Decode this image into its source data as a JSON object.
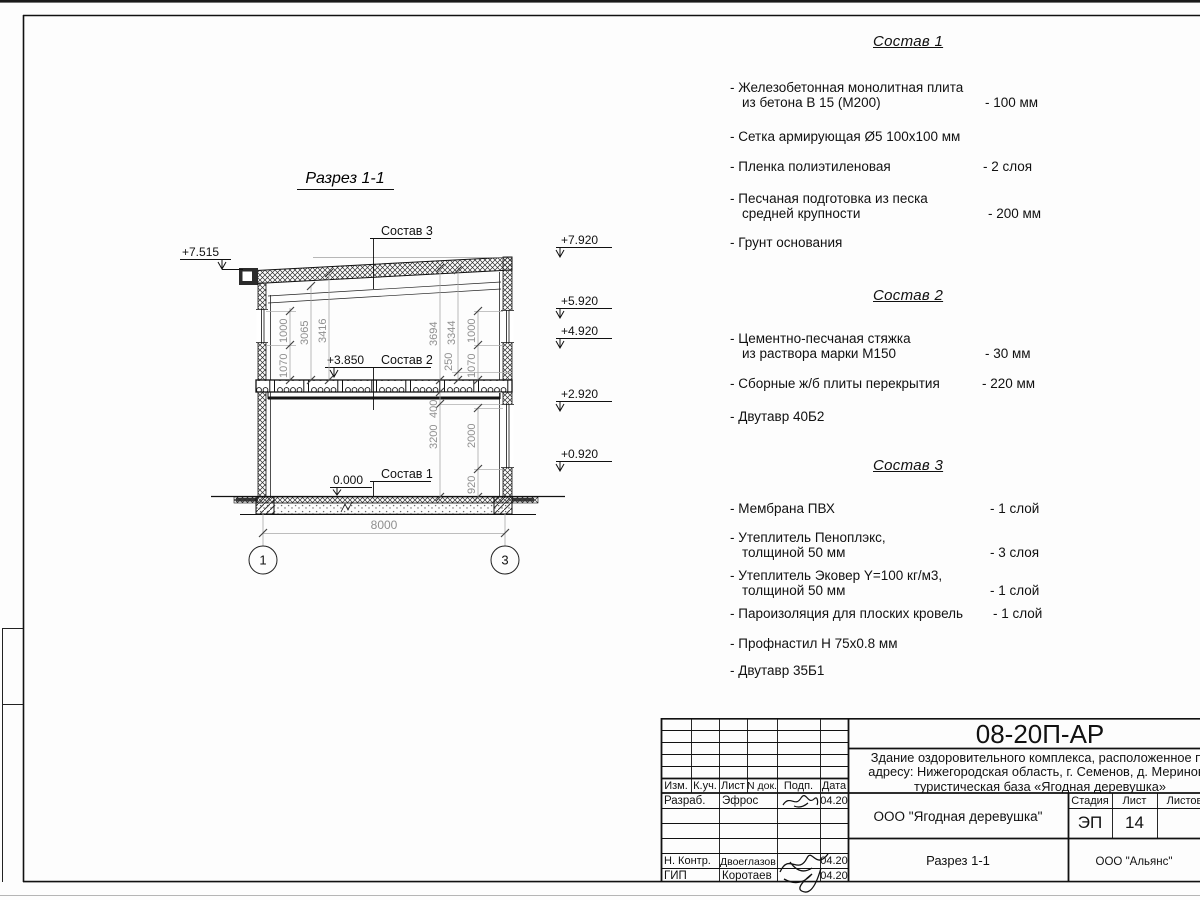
{
  "drawing": {
    "title": "Разрез 1-1",
    "elev_left_eave": "+7.515",
    "elev_right": [
      "+7.920",
      "+5.920",
      "+4.920",
      "+2.920",
      "+0.920"
    ],
    "elev_floor2": "+3.850",
    "elev_zero": "0.000",
    "label_sostav3": "Состав 3",
    "label_sostav2": "Состав 2",
    "label_sostav1": "Состав 1",
    "dims_left": [
      "1070",
      "1000",
      "3065",
      "3416"
    ],
    "dims_right_up": [
      "3694",
      "3344",
      "250",
      "1070",
      "1000"
    ],
    "dims_right_low": [
      "400",
      "3200",
      "2000",
      "920"
    ],
    "dim_span": "8000",
    "axis_left": "1",
    "axis_right": "3"
  },
  "specs": [
    {
      "title": "Состав 1",
      "items": [
        {
          "name": "- Железобетонная  монолитная плита\nиз бетона В 15 (М200)",
          "value": "- 100 мм"
        },
        {
          "name": "- Сетка армирующая Ø5 100х100 мм",
          "value": ""
        },
        {
          "name": "- Пленка полиэтиленовая",
          "value": "-  2 слоя"
        },
        {
          "name": "- Песчаная подготовка из песка\nсредней крупности",
          "value": "- 200 мм"
        },
        {
          "name": "- Грунт основания",
          "value": ""
        }
      ]
    },
    {
      "title": "Состав 2",
      "items": [
        {
          "name": "- Цементно-песчаная стяжка\nиз раствора марки М150",
          "value": "- 30 мм"
        },
        {
          "name": "- Сборные ж/б плиты перекрытия",
          "value": "- 220 мм"
        },
        {
          "name": "- Двутавр 40Б2",
          "value": ""
        }
      ]
    },
    {
      "title": "Состав 3",
      "items": [
        {
          "name": "- Мембрана ПВХ",
          "value": "- 1 слой"
        },
        {
          "name": "- Утеплитель Пеноплэкс,\nтолщиной 50 мм",
          "value": "- 3 слоя"
        },
        {
          "name": "- Утеплитель Эковер Y=100 кг/м3,\nтолщиной 50 мм",
          "value": "- 1 слой"
        },
        {
          "name": "- Пароизоляция для плоских кровель",
          "value": "- 1 слой"
        },
        {
          "name": "- Профнастил Н 75х0.8 мм",
          "value": ""
        },
        {
          "name": "- Двутавр 35Б1",
          "value": ""
        }
      ]
    }
  ],
  "titleblock": {
    "doc_number": "08-20П-АР",
    "project": "Здание оздоровительного комплекса, расположенное по\nадресу: Нижегородская область, г. Семенов, д. Мериново\nтуристическая база «Ягодная деревушка»",
    "company": "ООО \"Ягодная деревушка\"",
    "sheet_title": "Разрез 1-1",
    "contractor": "ООО \"Альянс\"",
    "stage_label": "Стадия",
    "sheet_label": "Лист",
    "sheets_label": "Листов",
    "stage_value": "ЭП",
    "sheet_value": "14",
    "cols": [
      "Изм.",
      "К.уч.",
      "Лист",
      "N док.",
      "Подп.",
      "Дата"
    ],
    "rows": [
      {
        "role": "Разраб.",
        "name": "Эфрос",
        "date": "04.20"
      },
      {
        "role": "",
        "name": "",
        "date": ""
      },
      {
        "role": "",
        "name": "",
        "date": ""
      },
      {
        "role": "",
        "name": "",
        "date": ""
      },
      {
        "role": "Н. Контр.",
        "name": "Двоеглазов",
        "date": "04.20"
      },
      {
        "role": "ГИП",
        "name": "Коротаев",
        "date": "04.20"
      }
    ]
  }
}
